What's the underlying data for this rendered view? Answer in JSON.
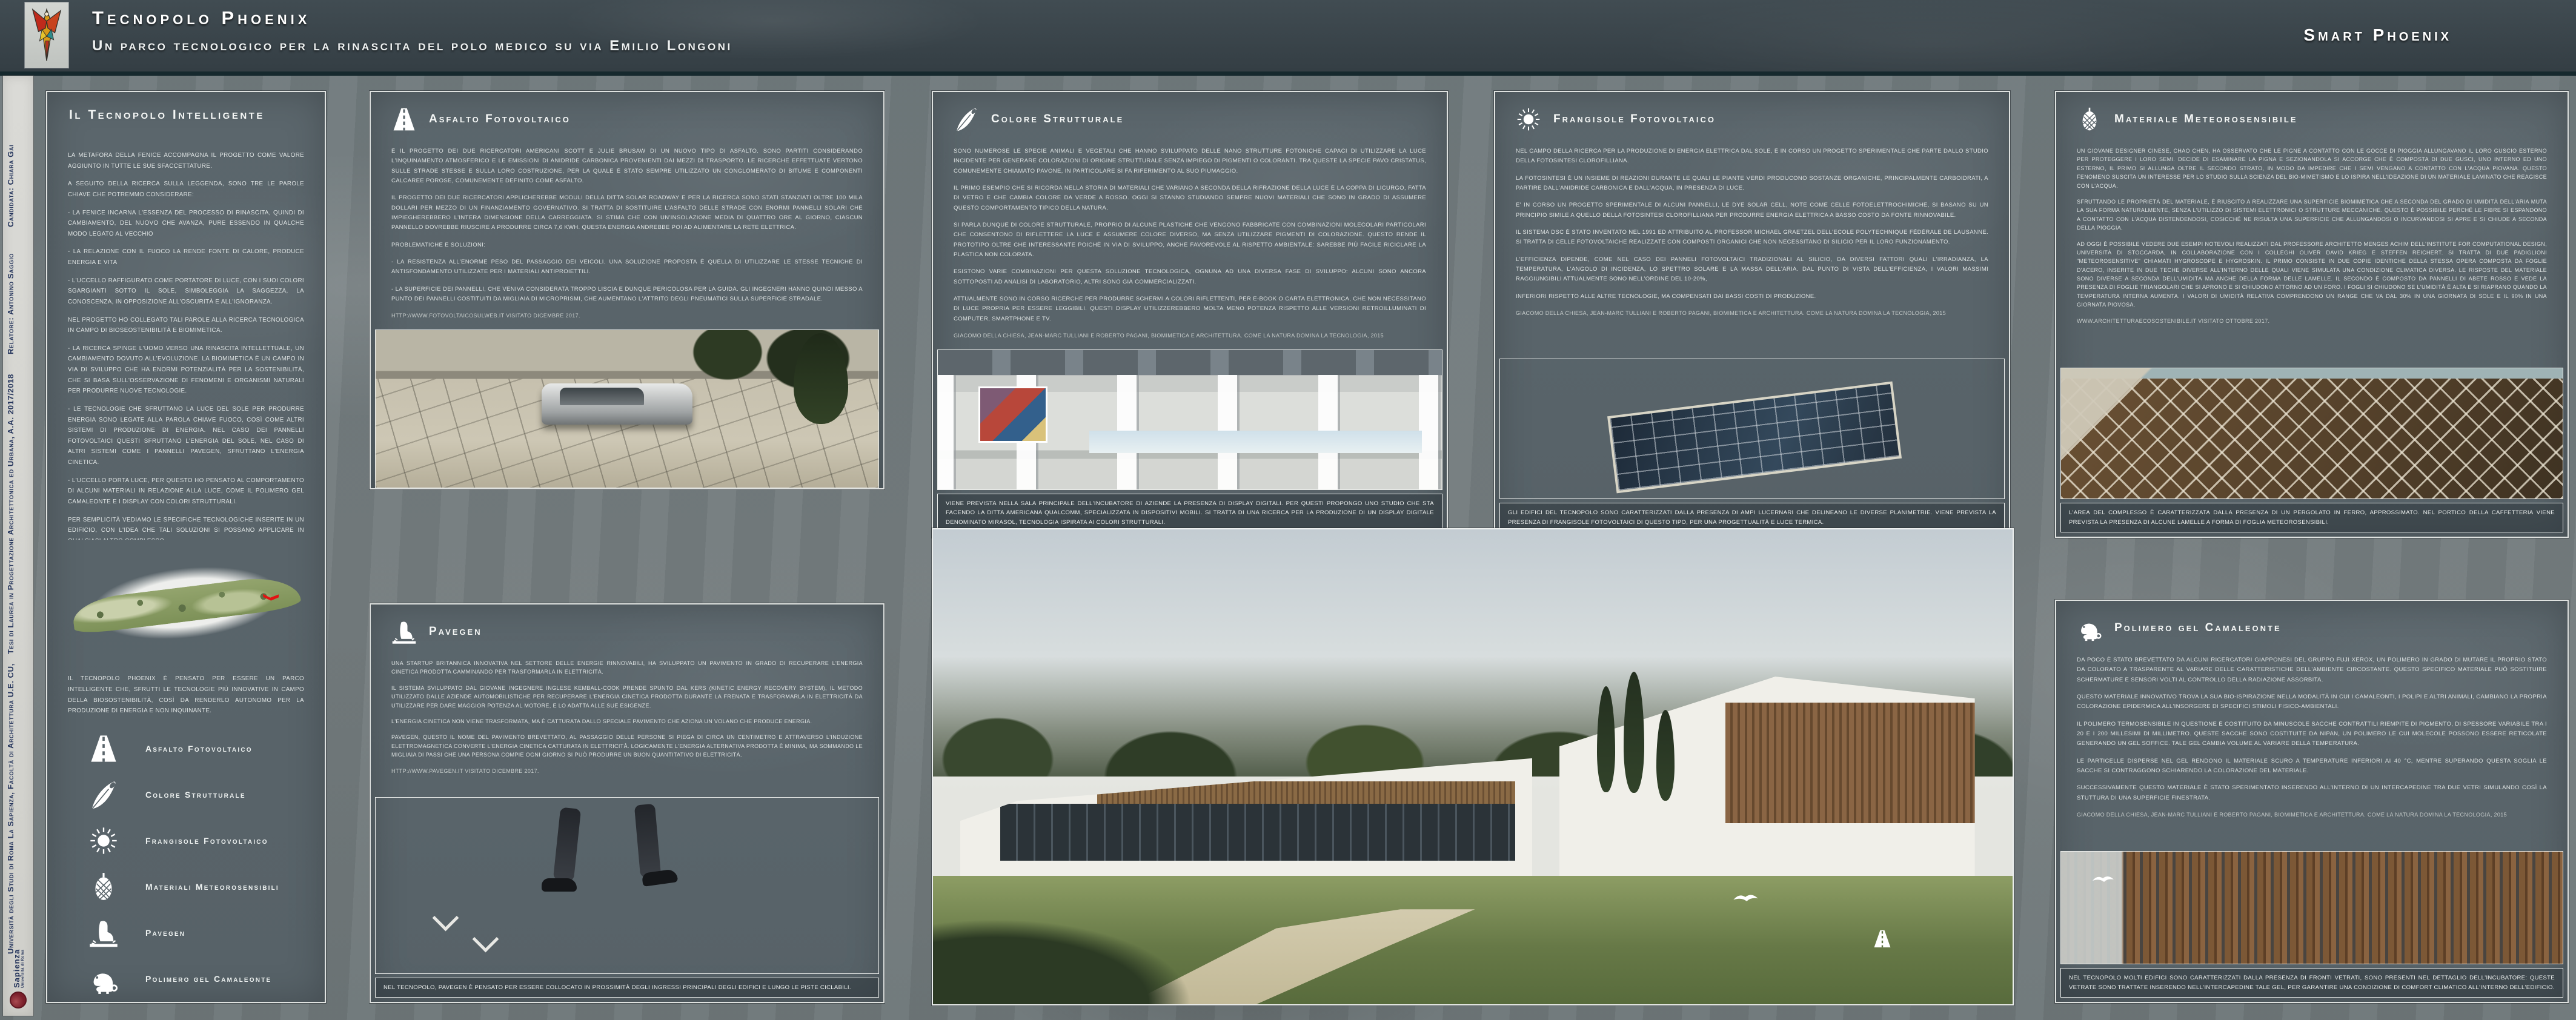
{
  "palette": {
    "header_bg": "#3a454b",
    "board_bg": "#727b7d",
    "panel_bg": "#59646a",
    "panel_border": "#dfe2e0",
    "accent_teal": "#16292e",
    "sidebar_bg": "#d8d7d3",
    "sidebar_text": "#25355c",
    "sapienza_red": "#7a1f2b",
    "map_marker_red": "#e21212",
    "text_light": "#dde2e2"
  },
  "header": {
    "logo": "phoenix-logo",
    "title": "Tecnopolo Phoenix",
    "subtitle": "Un parco tecnologico per la rinascita del polo medico su via Emilio Longoni",
    "right_title": "Smart Phoenix"
  },
  "sidebar": {
    "university_line": "Università degli Studi di Roma La Sapienza, Facoltà di Architettura U.E. CU,",
    "thesis_line": "Tesi di Laurea in Progettazione Architettonica ed Urbana, A.A. 2017/2018",
    "relatore": "Relatore: Antonino Saggio",
    "candidata": "Candidata: Chiara Gai",
    "logo_name": "Sapienza",
    "logo_subname": "Università di Roma"
  },
  "intro": {
    "title": "Il Tecnopolo Intelligente",
    "paragraphs": [
      "La metafora della Fenice accompagna il progetto come valore aggiunto in tutte le sue sfaccettature.",
      "A seguito della ricerca sulla leggenda, sono tre le parole chiave che potremmo considerare:",
      "- La Fenice incarna l'essenza del processo di rinascita, quindi di cambiamento, del nuovo che avanza, pure essendo in qualche modo legato al vecchio",
      "- La relazione con il fuoco la rende fonte di calore, produce energia e vita",
      "- L'uccello raffigurato come portatore di luce, con i suoi colori sgargianti sotto il sole, simboleggia la saggezza, la conoscenza, in opposizione all'oscurità e all'ignoranza.",
      "Nel progetto ho collegato tali parole alla ricerca tecnologica in campo di bioseostenibilità e biomimetica.",
      "- La ricerca spinge l'uomo verso una rinascita intellettuale, un cambiamento dovuto all'evoluzione. La biomimetica è un campo in via di sviluppo che ha enormi potenzialità per la sostenibilità, che si basa sull'osservazione di fenomeni e organismi naturali per produrre nuove tecnologie.",
      "- Le tecnologie che sfruttano la luce del sole per produrre energia sono legate alla parola chiave fuoco, così come altri sistemi di produzione di energia. Nel caso dei pannelli fotovoltaici questi sfruttano l'energia del sole, nel caso di altri sistemi come i pannelli Pavegen, sfruttano l'energia cinetica.",
      "- L'uccello porta luce, per questo ho pensato al comportamento di alcuni materiali in relazione alla luce, come il polimero gel camaleonte e i display con colori strutturali.",
      "Per semplicità vediamo le specifiche tecnologiche inserite in un edificio, con l'idea che tali soluzioni si possano applicare in qualsiasi altro complesso."
    ],
    "closing": "Il Tecnopolo Phoenix è pensato per essere un parco intelligente che, sfrutti le tecnologie più innovative in campo della biosostenibilità, così da renderlo autonomo per la produzione di energia e non inquinante.",
    "legend": [
      {
        "icon": "road-icon",
        "label": "Asfalto Fotovoltaico"
      },
      {
        "icon": "feather-icon",
        "label": "Colore Strutturale"
      },
      {
        "icon": "sun-icon",
        "label": "Frangisole Fotovoltaico"
      },
      {
        "icon": "pinecone-icon",
        "label": "Materiali Meteorosensibili"
      },
      {
        "icon": "footstep-icon",
        "label": "Pavegen"
      },
      {
        "icon": "chameleon-icon",
        "label": "Polimero gel Camaleonte"
      }
    ]
  },
  "panels": {
    "asfalto": {
      "icon": "road-icon",
      "title": "Asfalto Fotovoltaico",
      "paragraphs": [
        "È il progetto dei due ricercatori americani Scott e Julie Brusaw di un nuovo tipo di asfalto. Sono partiti considerando l'inquinamento atmosferico e le emissioni di anidride carbonica provenienti dai mezzi di trasporto. Le ricerche effettuate vertono sulle strade stesse e sulla loro costruzione, per la quale è stato sempre utilizzato un conglomerato di bitume e componenti calcaree porose, comunemente definito come asfalto.",
        "Il progetto dei due ricercatori applicherebbe moduli della ditta Solar Roadway e per la ricerca sono stati stanziati oltre 100 mila dollari per mezzo di un finanziamento governativo. Si tratta di sostituire l'asfalto delle strade con enormi pannelli solari che impiegherebbero l'intera dimensione della carreggiata. Si stima che con un'insolazione media di quattro ore al giorno, ciascun pannello dovrebbe riuscire a produrre circa 7,6 KWh. Questa energia andrebbe poi ad alimentare la rete elettrica.",
        "Problematiche e soluzioni:",
        "- La resistenza all'enorme peso del passaggio dei veicoli. Una soluzione proposta è quella di utilizzare le stesse tecniche di antisfondamento utilizzate per i materiali antiproiettili.",
        "- La superficie dei pannelli, che veniva considerata troppo liscia e dunque pericolosa per la guida. Gli ingegneri hanno quindi messo a punto dei pannelli costituiti da migliaia di microprismi, che aumentano l'attrito degli pneumatici sulla superficie stradale."
      ],
      "source": "http://www.fotovoltaicosulweb.it  visitato dicembre 2017."
    },
    "colore": {
      "icon": "feather-icon",
      "title": "Colore Strutturale",
      "paragraphs": [
        "Sono numerose le specie animali e vegetali che hanno sviluppato delle nano strutture fotoniche capaci di utilizzare la luce incidente per generare colorazioni di origine strutturale senza impiego di pigmenti o coloranti. Tra queste la specie Pavo Cristatus, comunemente chiamato pavone, in particolare si fa riferimento al suo piumaggio.",
        "Il primo esempio che si ricorda nella storia di materiali che variano a seconda della rifrazione della luce è la coppa di Licurgo, fatta di vetro e che cambia colore da verde a rosso. Oggi si stanno studiando sempre nuovi materiali che sono in grado di assumere questo comportamento tipico della natura.",
        "Si parla dunque di Colore Strutturale, proprio di alcune plastiche che vengono fabbricate con combinazioni molecolari particolari che consentono di riflettere la luce e assumere colore diverso, ma senza utilizzare pigmenti di colorazione. Questo rende il prototipo oltre che interessante poichè in via di sviluppo, anche favorevole al rispetto ambientale: sarebbe più facile riciclare la plastica non colorata.",
        "Esistono varie combinazioni per questa soluzione tecnologica, ognuna ad una diversa fase di sviluppo: alcuni sono ancora sottoposti ad analisi di laboratorio, altri sono già commercializzati.",
        "Attualmente sono in corso ricerche per produrre schermi a colori riflettenti, per e-book o carta elettronica, che non necessitano di luce propria per essere leggibili. Questi display utilizzerebbero molta meno potenza rispetto alle versioni retroilluminati di computer, smartphone e TV."
      ],
      "source": "Giacomo della Chiesa, Jean-Marc Tulliani e Roberto Pagani, Biomimetica e architettura. Come la natura domina la tecnologia, 2015",
      "caption": "Viene prevista nella sala principale dell'incubatore di aziende la presenza di display digitali. Per questi propongo uno studio che sta facendo la ditta americana Qualcomm, specializzata in dispositivi mobili. Si tratta di una ricerca per la produzione di un display digitale denominato Mirasol, tecnologia ispirata ai colori strutturali."
    },
    "frangisole": {
      "icon": "sun-icon",
      "title": "Frangisole Fotovoltaico",
      "paragraphs": [
        "Nel campo della ricerca per la produzione di energia elettrica dal sole, è in corso un progetto sperimentale che parte dallo studio della fotosintesi clorofilliana.",
        "La fotosintesi è un insieme di reazioni durante le quali le piante verdi producono sostanze organiche, principalmente carboidrati, a partire dall'anidride carbonica e dall'acqua, in presenza di luce.",
        "E' in corso un progetto sperimentale di alcuni pannelli, le Dye Solar cell, note come celle fotoelettrochimiche, si basano su un principio simile a quello della fotosintesi clorofilliana per produrre energia elettrica a basso costo da fonte rinnovabile.",
        "Il sistema DSC è stato inventato nel 1991 ed attribuito al professor Michael Graetzel dell'Ecole Polytechnique Fédérale de Lausanne. Si tratta di celle fotovoltaiche realizzate con composti organici che non necessitano di silicio per il loro funzionamento.",
        "L'efficienza dipende, come nel caso dei panneli fotovoltaici tradizionali al silicio, da diversi fattori quali l'irradianza, la temperatura, l'angolo di incidenza, lo spettro solare e la massa dell'aria. Dal punto di vista dell'efficienza, i valori massimi raggiungibili attualmente sono nell'ordine del 10-20%,",
        "inferiori rispetto alle altre tecnologie, ma compensati dai bassi costi di produzione."
      ],
      "source": "Giacomo della Chiesa, Jean-Marc Tulliani e Roberto Pagani, Biomimetica e architettura. Come la natura domina la tecnologia, 2015",
      "caption": "Gli edifici del Tecnopolo sono caratterizzati dalla presenza di ampi lucernari che delineano le diverse planimetrie. Viene prevista la presenza di frangisole fotovoltaici di questo tipo, per una progettualità e luce termica."
    },
    "materiale": {
      "icon": "pinecone-icon",
      "title": "Materiale Meteorosensibile",
      "paragraphs": [
        "Un giovane designer cinese, Chao Chen, ha osservato che le pigne a contatto con le gocce di pioggia allungavano il loro guscio esterno per proteggere i loro semi. Decide di esaminare la pigna e sezionandola si accorge che è composta di due gusci, uno interno ed uno esterno, il primo si allunga oltre il secondo strato, in modo da impedire che i semi vengano a contatto con l'acqua piovana. Questo fenomeno suscita un interesse per lo studio sulla scienza del bio-mimetismo e lo ispira nell'ideazione di un materiale laminato che reagisce con l'acqua.",
        "Sfruttando le proprietà del materiale, è riuscito a realizzare una superficie biomimetica che a seconda del grado di umidità dell'aria muta la sua forma naturalmente, senza l'utilizzo di sistemi elettronici o strutture meccaniche. Questo è possibile perché le fibre si espandono a contatto con l'acqua distendendosi, cosicché ne risulta una superficie che allungandosi o incurvandosi si apre e si chiude a seconda della pioggia.",
        "Ad oggi è possibile vedere due esempi notevoli realizzati dal professore architetto Menges Achim dell'Institute for Computational Design, Università di Stoccarda, in collaborazione con i colleghi Oliver David Krieg e Steffen Reichert. Si tratta di due padiglioni \"meteorosensitive\" chiamati Hygroscope e Hygroskin. Il primo consiste in due copie identiche della stessa opera composta da foglie d'acero, inserite in due teche diverse all'interno delle quali viene simulata una condizione climatica diversa. Le risposte del materiale sono diverse a seconda dell'umidità ma anche della forma delle lamelle. Il secondo è composto da pannelli di abete rosso e vede la presenza di foglie triangolari che si aprono e si chiudono attorno ad un foro. I fogli si chiudono se l'umidità è alta e si riaprano quando la temperatura interna aumenta. I valori di umidità relativa comprendono un range che va dal 30% in una giornata di sole e il 90% in una giornata piovosa."
      ],
      "source": "www.architetturaecosostenibile.it visitato ottobre 2017.",
      "caption": "L'area del complesso è caratterizzata dalla presenza di un pergolato in ferro, approssimato. Nel portico della caffetteria viene prevista la presenza di alcune lamelle a forma di foglia meteorosensibili."
    },
    "pavegen": {
      "icon": "footstep-icon",
      "title": "Pavegen",
      "paragraphs": [
        "Una startUp britannica innovativa nel settore delle energie rinnovabili, ha sviluppato un pavimento in grado di recuperare l'energia cinetica prodotta camminando per trasformarla in elettricità.",
        "Il sistema sviluppato dal giovane ingegnere inglese Kemball-Cook prende spunto dal KERS (Kinetic Energy Recovery System), il metodo utilizzato dalle aziende automobilistiche per recuperare l'energia cinetica prodotta durante la frenata e trasformarla in elettricità da utilizzare per dare maggior potenza al motore, e lo adatta alle sue esigenze.",
        "L'energia cinetica non viene trasformata, ma è catturata dallo speciale pavimento che aziona un volano che produce energia.",
        "Pavegen, questo il nome del pavimento brevettato, al passaggio delle persone si piega di circa un centimetro e attraverso l'induzione elettromagnetica converte l'energia cinetica catturata in elettricità. Logicamente l'energia alternativa prodotta è minima, ma sommando le migliaia di passi che una persona compie ogni giorno si può produrre un buon quantitativo di elettricità."
      ],
      "source": "http://www.pavegen.it  visitato dicembre 2017.",
      "caption": "Nel Tecnopolo, Pavegen è pensato per essere collocato in prossimità degli ingressi principali degli edifici e lungo le piste ciclabili."
    },
    "polimero": {
      "icon": "chameleon-icon",
      "title": "Polimero gel Camaleonte",
      "paragraphs": [
        "Da poco è stato brevettato da alcuni ricercatori giapponesi del gruppo Fuji Xerox, un polimero in grado di mutare il proprio stato da colorato a trasparente al variare delle caratteristiche dell'ambiente circostante. Questo specifico materiale può sostituire schermature e sensori volti al controllo della radiazione assorbita.",
        "Questo materiale innovativo trova la sua bio-ispirazione nella modalità in cui i camaleonti, i polipi e altri animali, cambiano la propria colorazione epidermica all'insorgere di specifici stimoli fisico-ambientali.",
        "Il polimero termosensibile in questione è costituito da minuscole sacche contrattili riempite di pigmento, di spessore variabile tra i 20 e i 200 millesimi di millimetro. Queste sacche sono costituite da Nipan, un polimero le cui molecole possono essere reticolate generando un gel soffice. Tale gel cambia volume al variare della temperatura.",
        "Le particelle disperse nel gel rendono il materiale scuro a temperature inferiori ai 40 °C, mentre superando questa soglia le sacche si contraggono schiarendo la colorazione del materiale.",
        "Successivamente questo materiale è stato sperimentato inserendo all'interno di un intercapedine tra due vetri simulando così la stuttura di una superficie finestrata."
      ],
      "source": "Giacomo della Chiesa, Jean-Marc Tulliani e Roberto Pagani, Biomimetica e architettura. Come la natura domina la tecnologia, 2015",
      "caption": "Nel Tecnopolo molti edifici sono caratterizzati dalla presenza di fronti vetrati, sono presenti nel dettaglio dell'incubatore: queste vetrate sono trattate inserendo nell'intercapedine tale gel, per garantire una condizione di comfort climatico all'interno dell'edificio."
    }
  }
}
